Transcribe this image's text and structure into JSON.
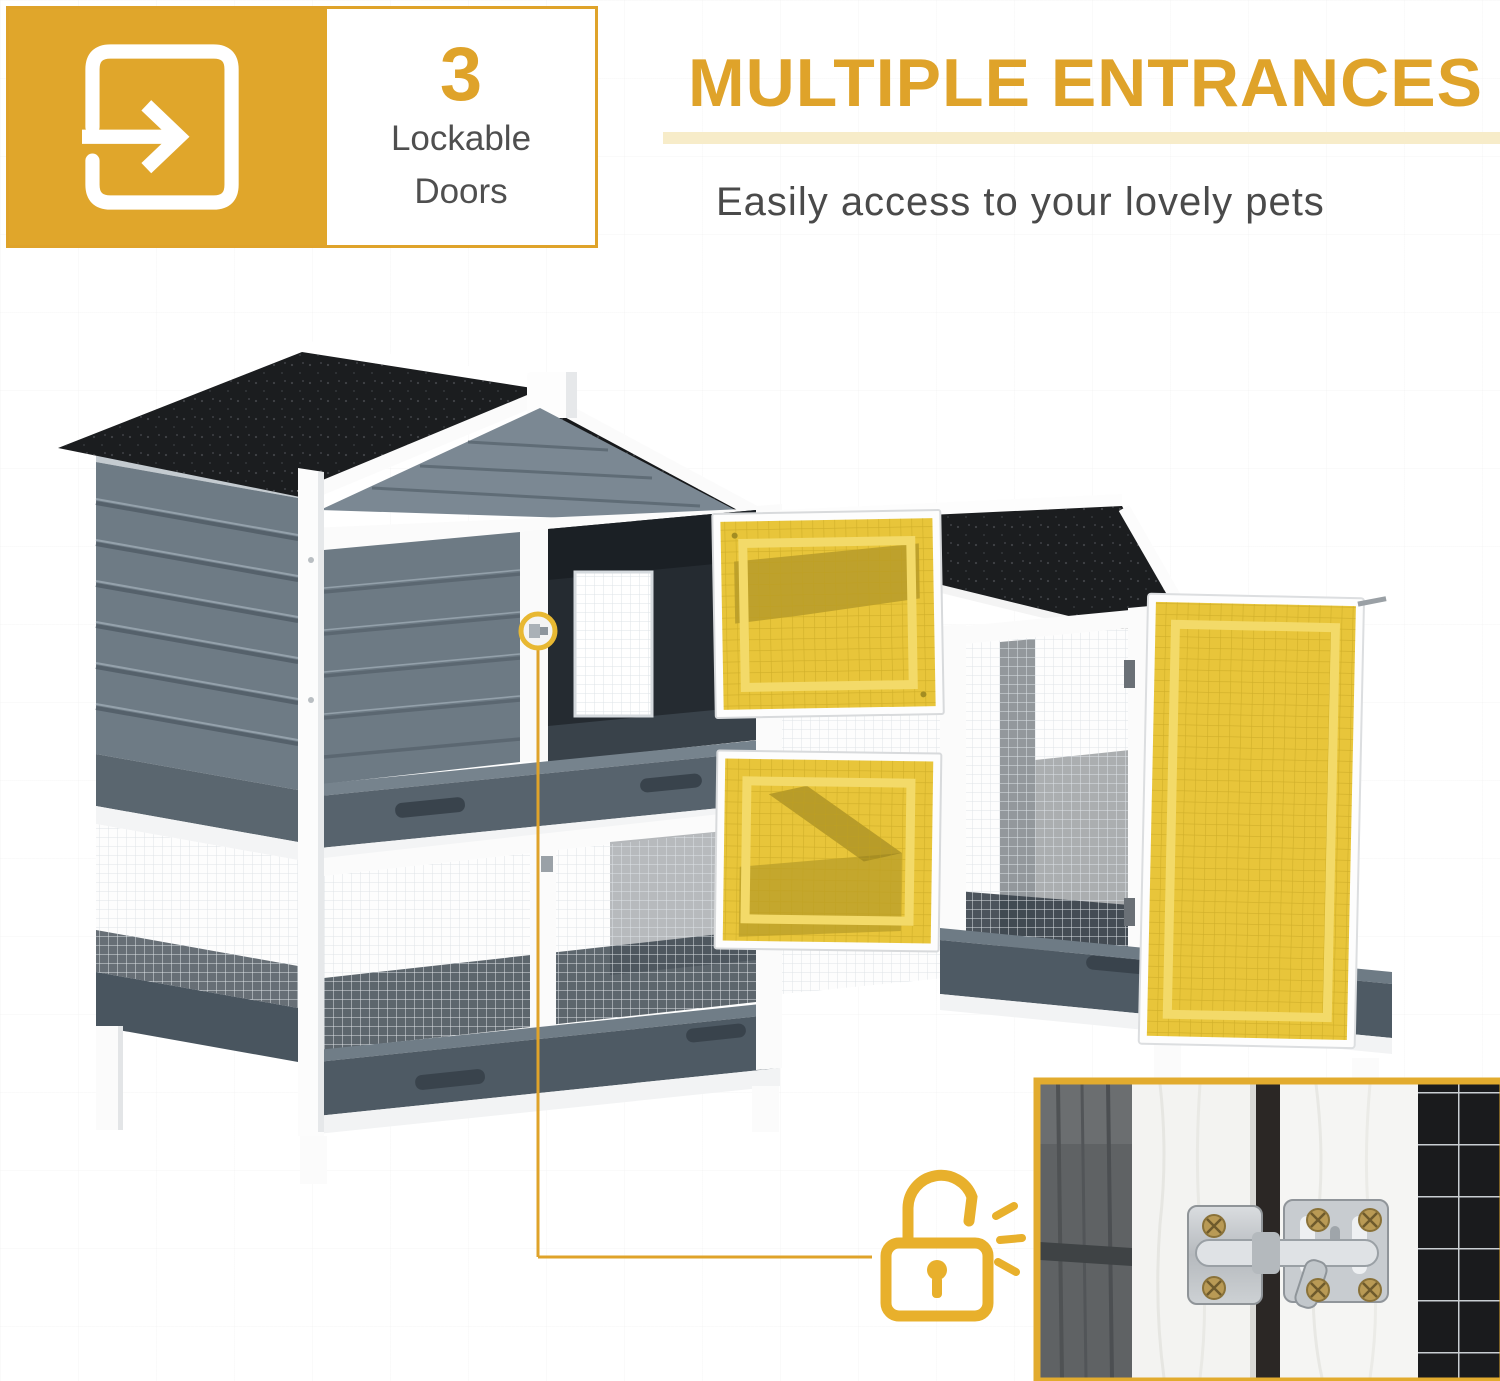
{
  "badge": {
    "count": "3",
    "label_line1": "Lockable",
    "label_line2": "Doors",
    "icon": "enter-door-arrow-icon"
  },
  "header": {
    "title": "MULTIPLE ENTRANCES",
    "subtitle": "Easily access to your lovely pets"
  },
  "product": {
    "subject": "two-story wooden rabbit hutch with side run",
    "highlighted_open_doors": 3,
    "latch_callout": "door latch circled and linked to padlock icon",
    "inset": "close-up photo of slide-bolt door latch"
  },
  "icons": {
    "entrance": "enter-door-arrow-icon",
    "lock": "padlock-unlocked-icon",
    "click_marks": "latch-click-lines"
  },
  "colors": {
    "accent": "#dfa32a",
    "accent_bright": "#e8b02c",
    "door_highlight": "#e8c53a",
    "door_highlight_inner": "#f3da69",
    "underline": "#f7ecc9",
    "text_gray": "#4a4a4a",
    "roof_black": "#1b1d1f",
    "wood_gray": "#6d7a84",
    "wood_gray_dark": "#57636d",
    "frame_white": "#fbfbfb",
    "tray_gray": "#4e5a64",
    "mesh_line": "#dee3e7"
  }
}
